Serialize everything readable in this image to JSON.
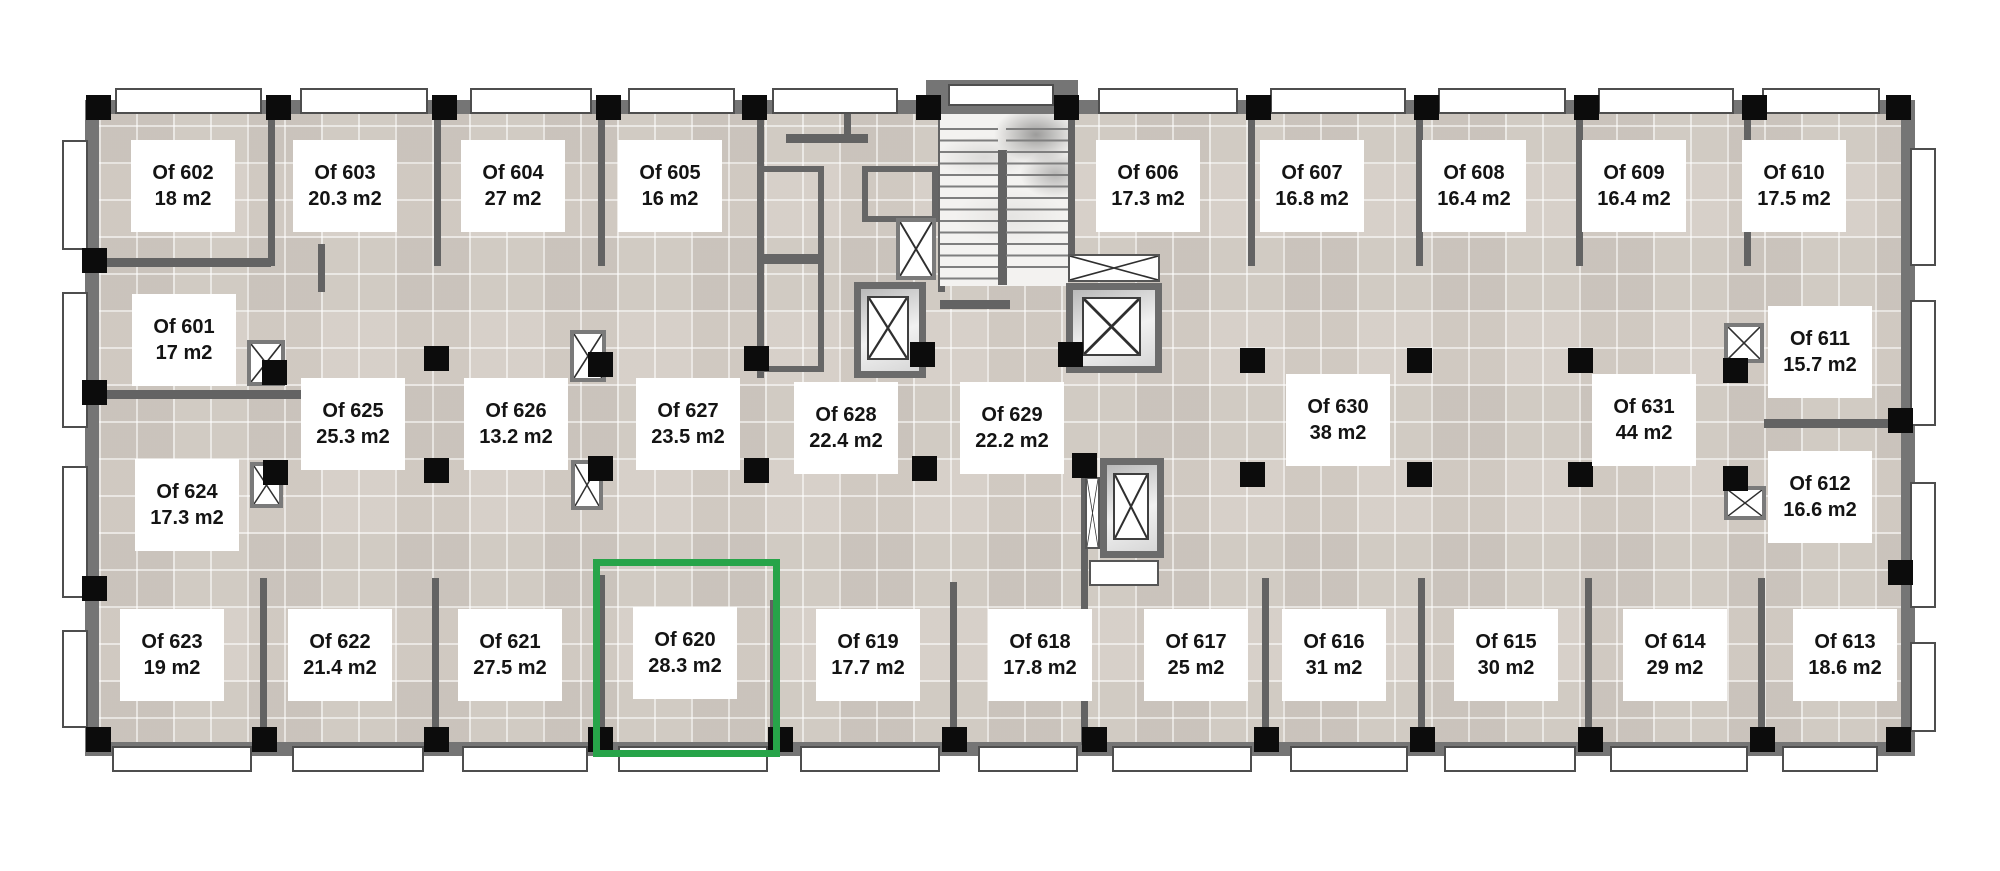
{
  "floorplan": {
    "name": "office-floor-plan",
    "unit_suffix": "m2",
    "highlight_color": "#27a449",
    "highlighted_office": "Of 620",
    "offices": [
      {
        "id": "Of 602",
        "area": "18 m2",
        "cx": 183,
        "cy": 186,
        "highlighted": false
      },
      {
        "id": "Of 603",
        "area": "20.3 m2",
        "cx": 345,
        "cy": 186,
        "highlighted": false
      },
      {
        "id": "Of 604",
        "area": "27 m2",
        "cx": 513,
        "cy": 186,
        "highlighted": false
      },
      {
        "id": "Of 605",
        "area": "16 m2",
        "cx": 670,
        "cy": 186,
        "highlighted": false
      },
      {
        "id": "Of 606",
        "area": "17.3 m2",
        "cx": 1148,
        "cy": 186,
        "highlighted": false
      },
      {
        "id": "Of 607",
        "area": "16.8 m2",
        "cx": 1312,
        "cy": 186,
        "highlighted": false
      },
      {
        "id": "Of 608",
        "area": "16.4 m2",
        "cx": 1474,
        "cy": 186,
        "highlighted": false
      },
      {
        "id": "Of 609",
        "area": "16.4 m2",
        "cx": 1634,
        "cy": 186,
        "highlighted": false
      },
      {
        "id": "Of 610",
        "area": "17.5 m2",
        "cx": 1794,
        "cy": 186,
        "highlighted": false
      },
      {
        "id": "Of 601",
        "area": "17 m2",
        "cx": 184,
        "cy": 340,
        "highlighted": false
      },
      {
        "id": "Of 611",
        "area": "15.7 m2",
        "cx": 1820,
        "cy": 352,
        "highlighted": false
      },
      {
        "id": "Of 624",
        "area": "17.3 m2",
        "cx": 187,
        "cy": 505,
        "highlighted": false
      },
      {
        "id": "Of 612",
        "area": "16.6 m2",
        "cx": 1820,
        "cy": 497,
        "highlighted": false
      },
      {
        "id": "Of 625",
        "area": "25.3 m2",
        "cx": 353,
        "cy": 424,
        "highlighted": false
      },
      {
        "id": "Of 626",
        "area": "13.2 m2",
        "cx": 516,
        "cy": 424,
        "highlighted": false
      },
      {
        "id": "Of 627",
        "area": "23.5 m2",
        "cx": 688,
        "cy": 424,
        "highlighted": false
      },
      {
        "id": "Of 628",
        "area": "22.4 m2",
        "cx": 846,
        "cy": 428,
        "highlighted": false
      },
      {
        "id": "Of 629",
        "area": "22.2 m2",
        "cx": 1012,
        "cy": 428,
        "highlighted": false
      },
      {
        "id": "Of 630",
        "area": "38 m2",
        "cx": 1338,
        "cy": 420,
        "highlighted": false
      },
      {
        "id": "Of 631",
        "area": "44 m2",
        "cx": 1644,
        "cy": 420,
        "highlighted": false
      },
      {
        "id": "Of 623",
        "area": "19 m2",
        "cx": 172,
        "cy": 655,
        "highlighted": false
      },
      {
        "id": "Of 622",
        "area": "21.4 m2",
        "cx": 340,
        "cy": 655,
        "highlighted": false
      },
      {
        "id": "Of 621",
        "area": "27.5 m2",
        "cx": 510,
        "cy": 655,
        "highlighted": false
      },
      {
        "id": "Of 620",
        "area": "28.3 m2",
        "cx": 685,
        "cy": 653,
        "highlighted": true
      },
      {
        "id": "Of 619",
        "area": "17.7 m2",
        "cx": 868,
        "cy": 655,
        "highlighted": false
      },
      {
        "id": "Of 618",
        "area": "17.8 m2",
        "cx": 1040,
        "cy": 655,
        "highlighted": false
      },
      {
        "id": "Of 617",
        "area": "25 m2",
        "cx": 1196,
        "cy": 655,
        "highlighted": false
      },
      {
        "id": "Of 616",
        "area": "31 m2",
        "cx": 1334,
        "cy": 655,
        "highlighted": false
      },
      {
        "id": "Of 615",
        "area": "30 m2",
        "cx": 1506,
        "cy": 655,
        "highlighted": false
      },
      {
        "id": "Of 614",
        "area": "29 m2",
        "cx": 1675,
        "cy": 655,
        "highlighted": false
      },
      {
        "id": "Of 613",
        "area": "18.6 m2",
        "cx": 1845,
        "cy": 655,
        "highlighted": false
      }
    ]
  }
}
